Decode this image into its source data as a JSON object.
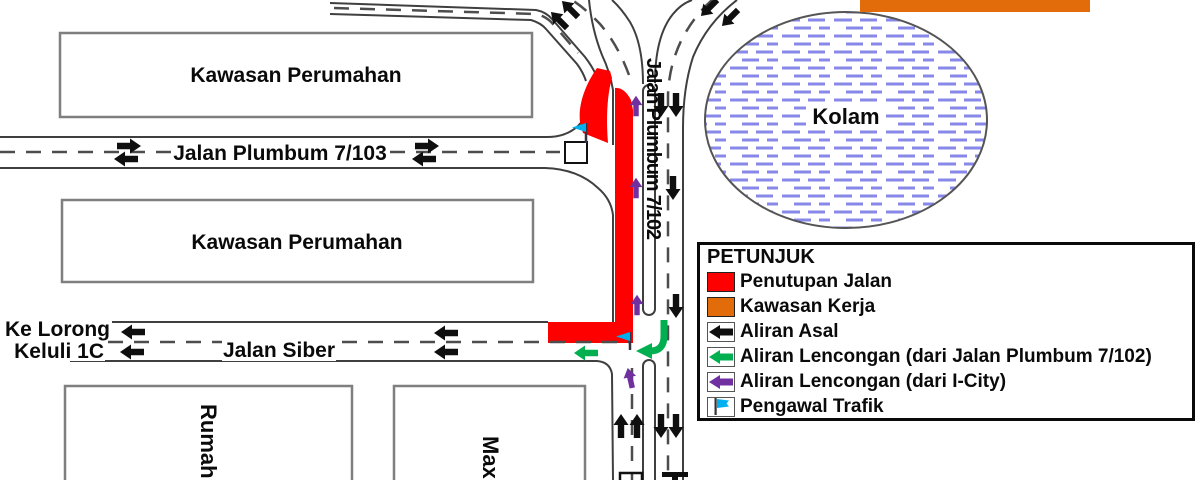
{
  "map": {
    "labels": {
      "residential_area_1": "Kawasan Perumahan",
      "residential_area_2": "Kawasan Perumahan",
      "road_plumbum_7103": "Jalan Plumbum 7/103",
      "road_plumbum_7102": "Jalan Plumbum 7/102",
      "road_siber": "Jalan Siber",
      "to_keluli_line1": "Ke Lorong",
      "to_keluli_line2": "Keluli 1C",
      "pond": "Kolam",
      "shophouses": "Rumah K",
      "maxis_building": "Maxis"
    },
    "colors": {
      "closure_red": "#FF0000",
      "work_area_orange": "#E36C0A",
      "original_flow_black": "#0F0F0F",
      "diversion_green": "#00B050",
      "diversion_purple": "#7030A0",
      "flag_blue": "#00B0F0",
      "pond_hatch_blue": "#8888E8"
    }
  },
  "legend": {
    "title": "PETUNJUK",
    "items": [
      {
        "label": "Penutupan Jalan",
        "color": "#FF0000"
      },
      {
        "label": "Kawasan Kerja",
        "color": "#E36C0A"
      },
      {
        "label": "Aliran Asal",
        "color": "#0F0F0F"
      },
      {
        "label": "Aliran Lencongan (dari Jalan Plumbum 7/102)",
        "color": "#00B050"
      },
      {
        "label": "Aliran Lencongan (dari I-City)",
        "color": "#7030A0"
      },
      {
        "label": "Pengawal Trafik",
        "color": "#00B0F0"
      }
    ]
  }
}
